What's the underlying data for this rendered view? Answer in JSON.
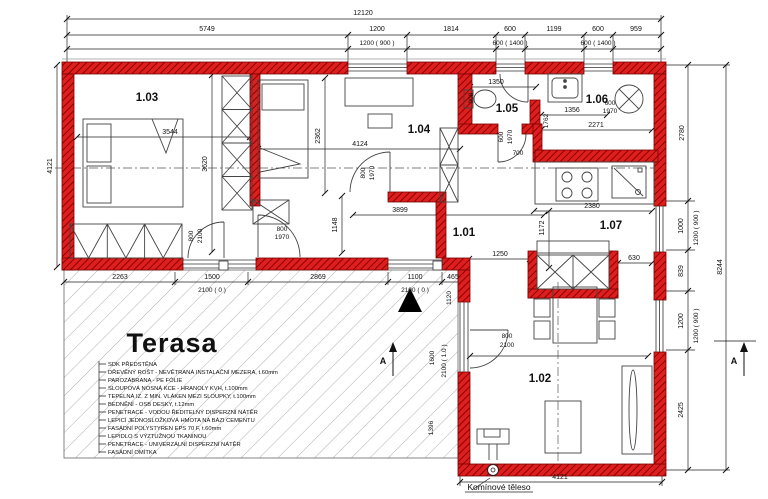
{
  "title": "Floor plan – ground floor",
  "rooms": {
    "r101": "1.01",
    "r102": "1.02",
    "r103": "1.03",
    "r104": "1.04",
    "r105": "1.05",
    "r106": "1.06",
    "r107": "1.07"
  },
  "dims_top": {
    "total": "12120",
    "segments": [
      "5749",
      "1200",
      "1814",
      "600",
      "1199",
      "600",
      "959"
    ],
    "windows": [
      "1200 ( 900 )",
      "600 ( 1400 )",
      "600 ( 1400 )"
    ]
  },
  "dims_left": {
    "total": "4121"
  },
  "dims_right": {
    "segments": [
      "2780",
      "1000",
      "839",
      "1200",
      "2425"
    ],
    "windows": [
      "1200 ( 900 )",
      "1200 ( 900 )"
    ],
    "total": "8244"
  },
  "dims_bottom": {
    "total": "4121"
  },
  "terrace_dims": {
    "s1": "2263",
    "s2": "2869",
    "s3": "465",
    "s4": "1120"
  },
  "doors": {
    "terrace_door": {
      "w": "1500",
      "h": "2100 ( 0 )"
    },
    "entrance": {
      "w": "1100",
      "h": "2100 ( 0 )"
    },
    "d103": {
      "w": "800",
      "h": "2100"
    },
    "d101": {
      "w": "800",
      "h": "1970"
    },
    "d104": {
      "w": "800",
      "h": "1970"
    },
    "d105": {
      "w": "600",
      "h": "1970"
    },
    "nook": "700",
    "d106": {
      "w": "600",
      "h": "1970"
    },
    "d102": {
      "w": "800",
      "h": "2100"
    },
    "terrace_window": {
      "w": "1600",
      "h": "2100 ( 1.0 )"
    }
  },
  "interior": {
    "r103": {
      "bed": "3544",
      "depth": "3620"
    },
    "r104": {
      "depth": "2362",
      "width": "4124",
      "hall": "3899",
      "hall_depth": "1148"
    },
    "r105": {
      "width": "1350",
      "depth": "908"
    },
    "r106": {
      "sink": "1356",
      "depth": "1762",
      "width": "2271"
    },
    "kitchen": {
      "counter": "2380",
      "depth": "1172"
    },
    "r107": {
      "left": "1250",
      "right": "630"
    },
    "r102": {
      "width": "3629",
      "wall": "1396"
    }
  },
  "terrace": {
    "title": "Terasa",
    "notes": [
      "SDK PŘEDSTĚNA",
      "DŘEVĚNÝ ROŠT - NEVĚTRANÁ INSTALAČNÍ MEZERA, t.60mm",
      "PAROZÁBRANA - PE FÓLIE",
      "SLOUPOVÁ NOSNÁ KCE - HRANOLY KVH, t.100mm",
      "TEPELNÁ IZ. Z MIN. VLÁKEN MEZI SLOUPKY, t.100mm",
      "BEDNĚNÍ - OSB DESKY, t.12mm",
      "PENETRACE - VODOU ŘEDITELNÝ DISPERZNÍ NÁTĚR",
      "LEPICÍ JEDNOSLOŽKOVÁ HMOTA NA BÁZI CEMENTU",
      "FASÁDNÍ POLYSTYREN EPS 70 F, t.60mm",
      "LEPIDLO S VÝZTUŽNOU TKANINOU",
      "PENETRACE - UNIVERZÁLNÍ DISPERZNÍ NÁTĚR",
      "FASÁDNÍ OMÍTKA"
    ]
  },
  "chimney_label": "Komínové těleso",
  "section_label": "A",
  "colors": {
    "wall": "#dd1f1f",
    "wall_dark": "#8f0000",
    "hatch": "#b0b0b0"
  }
}
